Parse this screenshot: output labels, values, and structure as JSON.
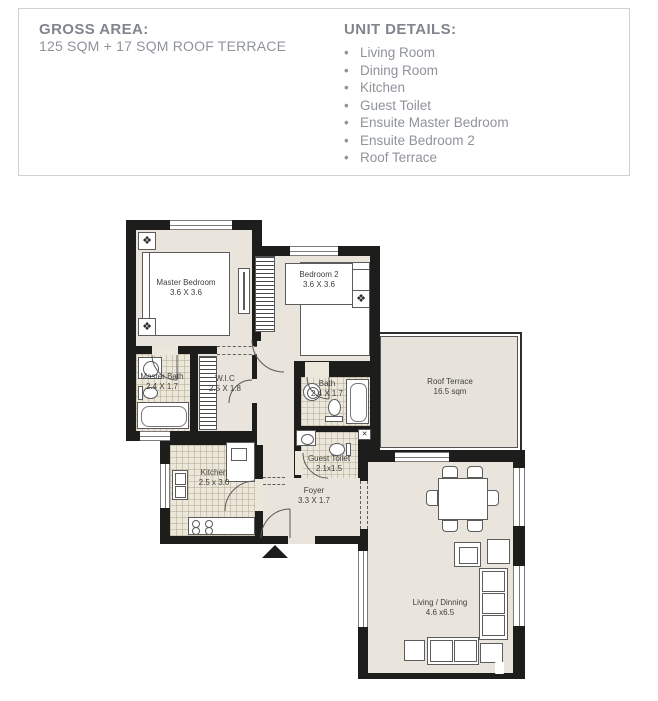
{
  "header": {
    "gross_area": {
      "title": "GROSS AREA:",
      "value": "125 SQM + 17 SQM ROOF TERRACE"
    },
    "unit_details": {
      "title": "UNIT DETAILS:",
      "bullet": "•",
      "items": [
        "Living Room",
        "Dining Room",
        "Kitchen",
        "Guest Toilet",
        "Ensuite Master Bedroom",
        "Ensuite Bedroom 2",
        "Roof Terrace"
      ]
    }
  },
  "floorplan": {
    "rooms": {
      "master_bedroom": {
        "name": "Master Bedroom",
        "dims": "3.6 X 3.6"
      },
      "bedroom2": {
        "name": "Bedroom 2",
        "dims": "3.6 X 3.6"
      },
      "master_bath": {
        "name": "Master Bath",
        "dims": "2.4 X 1.7"
      },
      "wic": {
        "name": "W.I.C",
        "dims": "2.5 X 1.8"
      },
      "bath": {
        "name": "Bath",
        "dims": "2.4 X 1.7"
      },
      "guest_toilet": {
        "name": "Guest Toilet",
        "dims": "2.1x1.5"
      },
      "kitchen": {
        "name": "Kitchen",
        "dims": "2.5 x 3.0"
      },
      "foyer": {
        "name": "Foyer",
        "dims": "3.3 X 1.7"
      },
      "roof_terrace": {
        "name": "Roof Terrace",
        "dims": "16.5 sqm"
      },
      "living_dining": {
        "name": "Living / Dinning",
        "dims": "4.6 x6.5"
      }
    },
    "icons": {
      "compass": "❖",
      "window_x": "✕"
    },
    "colors": {
      "wall": "#1d1d1b",
      "floor": "#e9e5dc",
      "tile": "#ece7db",
      "terrace": "#e7e3da",
      "header_text": "#8f939a"
    }
  }
}
